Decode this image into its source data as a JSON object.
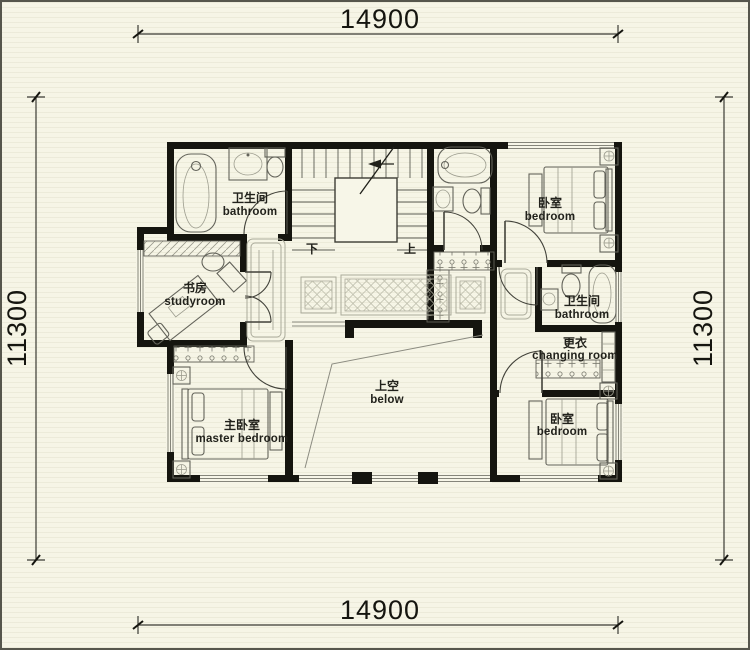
{
  "dimensions": {
    "top": "14900",
    "bottom": "14900",
    "left": "11300",
    "right": "11300"
  },
  "rooms": {
    "bathroom_top_left": {
      "zh": "卫生间",
      "en": "bathroom"
    },
    "bedroom_top_right": {
      "zh": "卧室",
      "en": "bedroom"
    },
    "study": {
      "zh": "书房",
      "en": "studyroom"
    },
    "bathroom_right": {
      "zh": "卫生间",
      "en": "bathroom"
    },
    "changing_room": {
      "zh": "更衣",
      "en": "changing room"
    },
    "master_bedroom": {
      "zh": "主卧室",
      "en": "master bedroom"
    },
    "bedroom_bottom_right": {
      "zh": "卧室",
      "en": "bedroom"
    },
    "void": {
      "zh": "上空",
      "en": "below"
    }
  },
  "stairs": {
    "down_label": "下",
    "up_label": "上"
  },
  "colors": {
    "background": "#f6f5e6",
    "wall": "#15150f",
    "dimension": "#15150f"
  }
}
